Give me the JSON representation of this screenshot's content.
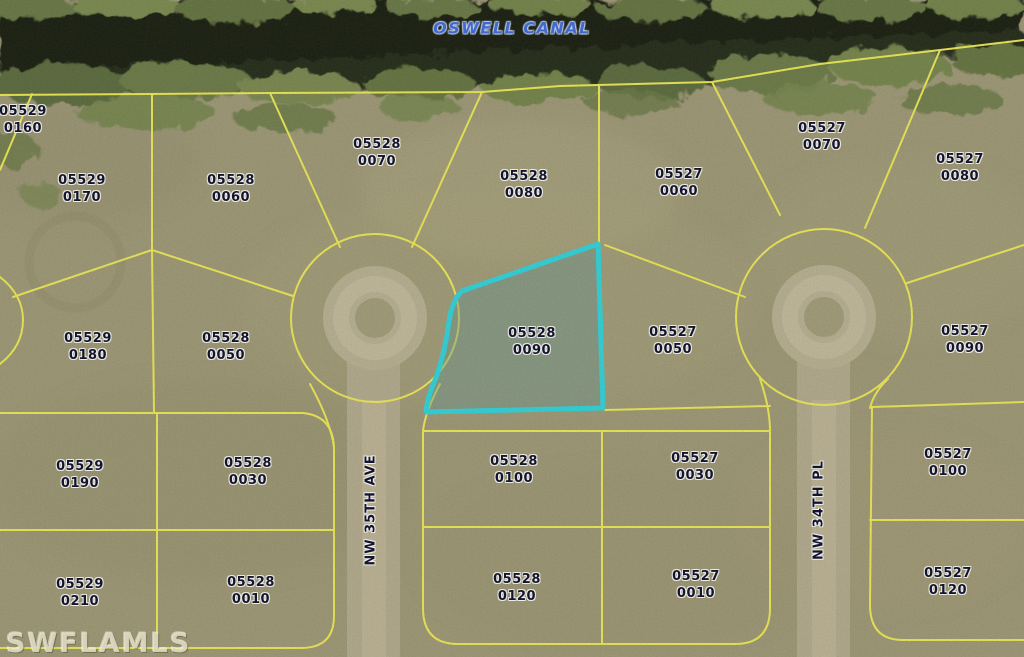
{
  "map": {
    "canal_label": "OSWELL CANAL",
    "watermark": "SWFLAMLS",
    "streets": [
      {
        "name": "NW 35TH AVE",
        "x": 371,
        "y": 510
      },
      {
        "name": "NW 34TH PL",
        "x": 819,
        "y": 510
      }
    ],
    "highlighted_parcel_id": "05528 0090",
    "parcels": [
      {
        "line1": "05529",
        "line2": "0160",
        "x": 23,
        "y": 121,
        "highlighted": false
      },
      {
        "line1": "05529",
        "line2": "0170",
        "x": 82,
        "y": 190,
        "highlighted": false
      },
      {
        "line1": "05528",
        "line2": "0060",
        "x": 231,
        "y": 190,
        "highlighted": false
      },
      {
        "line1": "05528",
        "line2": "0070",
        "x": 377,
        "y": 154,
        "highlighted": false
      },
      {
        "line1": "05528",
        "line2": "0080",
        "x": 524,
        "y": 186,
        "highlighted": false
      },
      {
        "line1": "05527",
        "line2": "0060",
        "x": 679,
        "y": 184,
        "highlighted": false
      },
      {
        "line1": "05527",
        "line2": "0070",
        "x": 822,
        "y": 138,
        "highlighted": false
      },
      {
        "line1": "05527",
        "line2": "0080",
        "x": 960,
        "y": 169,
        "highlighted": false
      },
      {
        "line1": "05529",
        "line2": "0180",
        "x": 88,
        "y": 348,
        "highlighted": false
      },
      {
        "line1": "05528",
        "line2": "0050",
        "x": 226,
        "y": 348,
        "highlighted": false
      },
      {
        "line1": "05528",
        "line2": "0090",
        "x": 532,
        "y": 343,
        "highlighted": true
      },
      {
        "line1": "05527",
        "line2": "0050",
        "x": 673,
        "y": 342,
        "highlighted": false
      },
      {
        "line1": "05527",
        "line2": "0090",
        "x": 965,
        "y": 341,
        "highlighted": false
      },
      {
        "line1": "05529",
        "line2": "0190",
        "x": 80,
        "y": 476,
        "highlighted": false
      },
      {
        "line1": "05528",
        "line2": "0030",
        "x": 248,
        "y": 473,
        "highlighted": false
      },
      {
        "line1": "05528",
        "line2": "0100",
        "x": 514,
        "y": 471,
        "highlighted": false
      },
      {
        "line1": "05527",
        "line2": "0030",
        "x": 695,
        "y": 468,
        "highlighted": false
      },
      {
        "line1": "05527",
        "line2": "0100",
        "x": 948,
        "y": 464,
        "highlighted": false
      },
      {
        "line1": "05529",
        "line2": "0210",
        "x": 80,
        "y": 594,
        "highlighted": false
      },
      {
        "line1": "05528",
        "line2": "0010",
        "x": 251,
        "y": 592,
        "highlighted": false
      },
      {
        "line1": "05528",
        "line2": "0120",
        "x": 517,
        "y": 589,
        "highlighted": false
      },
      {
        "line1": "05527",
        "line2": "0010",
        "x": 696,
        "y": 586,
        "highlighted": false
      },
      {
        "line1": "05527",
        "line2": "0120",
        "x": 948,
        "y": 583,
        "highlighted": false
      }
    ],
    "colors": {
      "boundary_line": "#f2ee55",
      "highlight_border": "#2fd8df",
      "highlight_fill": "rgba(95,150,150,0.38)",
      "parcel_label": "#14142e",
      "canal_text": "#4468cc",
      "ground": "#a19b77",
      "road": "#b9b093",
      "canal_water": "#151a0f"
    }
  }
}
